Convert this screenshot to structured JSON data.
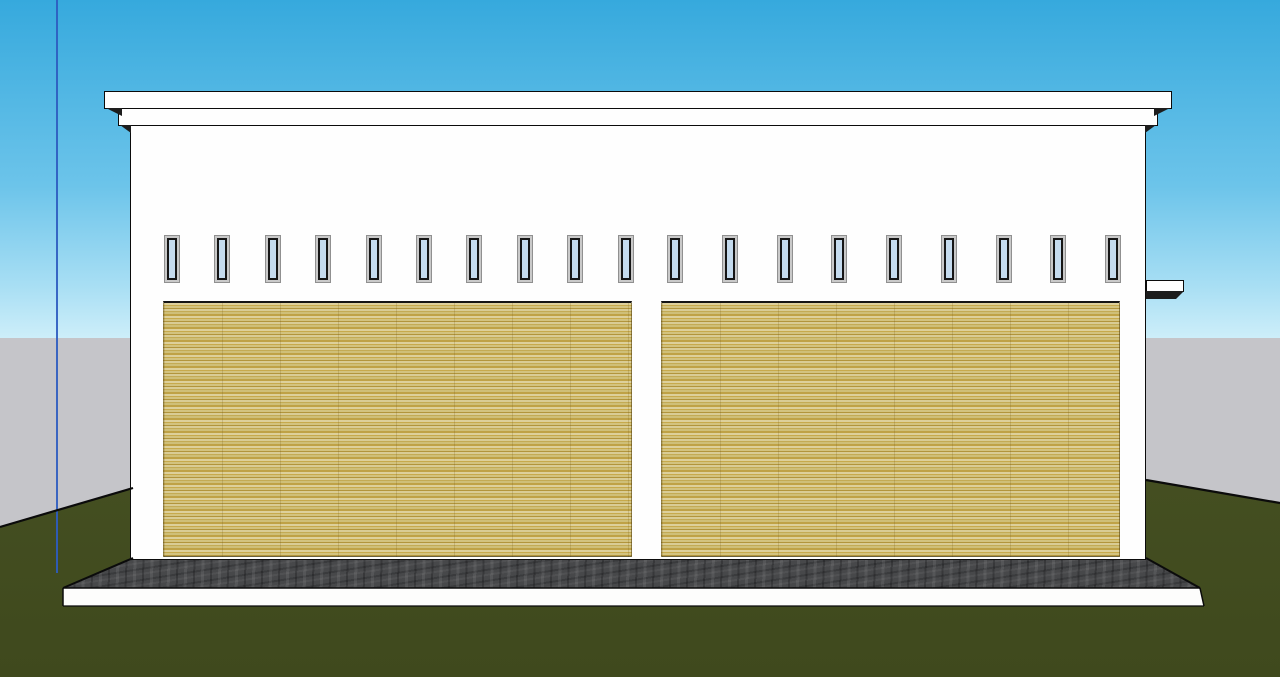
{
  "scene": {
    "description": "3D model viewport: front elevation of a white flat-roof two-bay building with tan roller-shutter doors, clerestory window strip, concrete apron and grass ground",
    "canvas": {
      "width": 1280,
      "height": 677
    }
  },
  "colors": {
    "sky_top": "#36a9dd",
    "sky_mid": "#6cc4ea",
    "sky_lower": "#a9dff4",
    "sky_horizon": "#cdeef9",
    "backdrop_gray": "#c5c5c9",
    "grass_green": "#4a5526",
    "grass_dark": "#3f491d",
    "concrete_dark": "#47484a",
    "slab_white": "#fdfdfc",
    "wall_white": "#fefefe",
    "outline_black": "#0b0b0b",
    "window_glass_blue": "#c5dbee",
    "window_frame_gray": "#c9c9c9",
    "window_frame_dark": "#161616",
    "axis_blue": "#2e5cc0",
    "shadow_dark": "#1d1d1d",
    "door_stripe_1": "#ddd09b",
    "door_stripe_2": "#c7aa4c",
    "door_stripe_3": "#d3c37f",
    "door_stripe_4": "#b2953c",
    "door_stripe_5": "#d9cc95",
    "door_stripe_6": "#c3ab55",
    "door_stripe_7": "#cfbf78",
    "door_stripe_8": "#bfa246"
  },
  "layout": {
    "sky": {
      "x": 0,
      "y": 0,
      "w": 1280,
      "h": 338
    },
    "backdrop": {
      "x": 0,
      "y": 338,
      "w": 1280,
      "h": 339
    },
    "axis_line": {
      "x": 56,
      "y": 0,
      "w": 2,
      "h": 573
    },
    "parapet_cap": {
      "x": 104,
      "y": 91,
      "w": 1068,
      "h": 18
    },
    "parapet_band": {
      "x": 118,
      "y": 108,
      "w": 1040,
      "h": 18
    },
    "wall": {
      "x": 130,
      "y": 125,
      "w": 1016,
      "h": 435
    },
    "door_left": {
      "x": 163,
      "y": 301,
      "w": 469,
      "h": 256
    },
    "door_right": {
      "x": 661,
      "y": 301,
      "w": 459,
      "h": 256
    },
    "ledge": {
      "x": 1146,
      "y": 280,
      "w": 38,
      "h": 12
    },
    "window_row": {
      "y": 235,
      "w": 16,
      "h": 48
    }
  },
  "windows": {
    "count": 19,
    "x_positions": [
      164,
      214,
      265,
      315,
      366,
      416,
      466,
      517,
      567,
      618,
      667,
      722,
      777,
      831,
      886,
      941,
      996,
      1050,
      1105
    ]
  },
  "polygons": {
    "grass": [
      [
        0,
        527
      ],
      [
        133,
        488
      ],
      [
        1146,
        480
      ],
      [
        1280,
        503
      ],
      [
        1280,
        677
      ],
      [
        0,
        677
      ]
    ],
    "concrete": [
      [
        133,
        558
      ],
      [
        1146,
        558
      ],
      [
        1200,
        588
      ],
      [
        63,
        588
      ]
    ],
    "slab": [
      [
        63,
        588
      ],
      [
        1200,
        588
      ],
      [
        1204,
        606
      ],
      [
        63,
        606
      ]
    ]
  },
  "shadow_polygons": [
    [
      [
        106,
        108
      ],
      [
        122,
        108
      ],
      [
        122,
        116
      ]
    ],
    [
      [
        1154,
        108
      ],
      [
        1170,
        108
      ],
      [
        1154,
        116
      ]
    ],
    [
      [
        120,
        125
      ],
      [
        131,
        125
      ],
      [
        131,
        133
      ]
    ],
    [
      [
        1145,
        125
      ],
      [
        1156,
        125
      ],
      [
        1145,
        133
      ]
    ],
    [
      [
        1146,
        291
      ],
      [
        1184,
        291
      ],
      [
        1176,
        299
      ],
      [
        1146,
        299
      ]
    ]
  ],
  "outline_segments": [
    {
      "p": [
        [
          0,
          527
        ],
        [
          133,
          488
        ]
      ],
      "w": 2.2
    },
    {
      "p": [
        [
          1146,
          480
        ],
        [
          1280,
          503
        ]
      ],
      "w": 2.2
    },
    {
      "p": [
        [
          63,
          588
        ],
        [
          133,
          558
        ]
      ],
      "w": 2
    },
    {
      "p": [
        [
          1146,
          558
        ],
        [
          1200,
          588
        ]
      ],
      "w": 2
    },
    {
      "p": [
        [
          63,
          588
        ],
        [
          1200,
          588
        ]
      ],
      "w": 1.5
    },
    {
      "p": [
        [
          63,
          588
        ],
        [
          63,
          606
        ]
      ],
      "w": 1.5
    },
    {
      "p": [
        [
          1200,
          588
        ],
        [
          1204,
          606
        ]
      ],
      "w": 1.5
    },
    {
      "p": [
        [
          63,
          606
        ],
        [
          1204,
          606
        ]
      ],
      "w": 1.2
    }
  ]
}
